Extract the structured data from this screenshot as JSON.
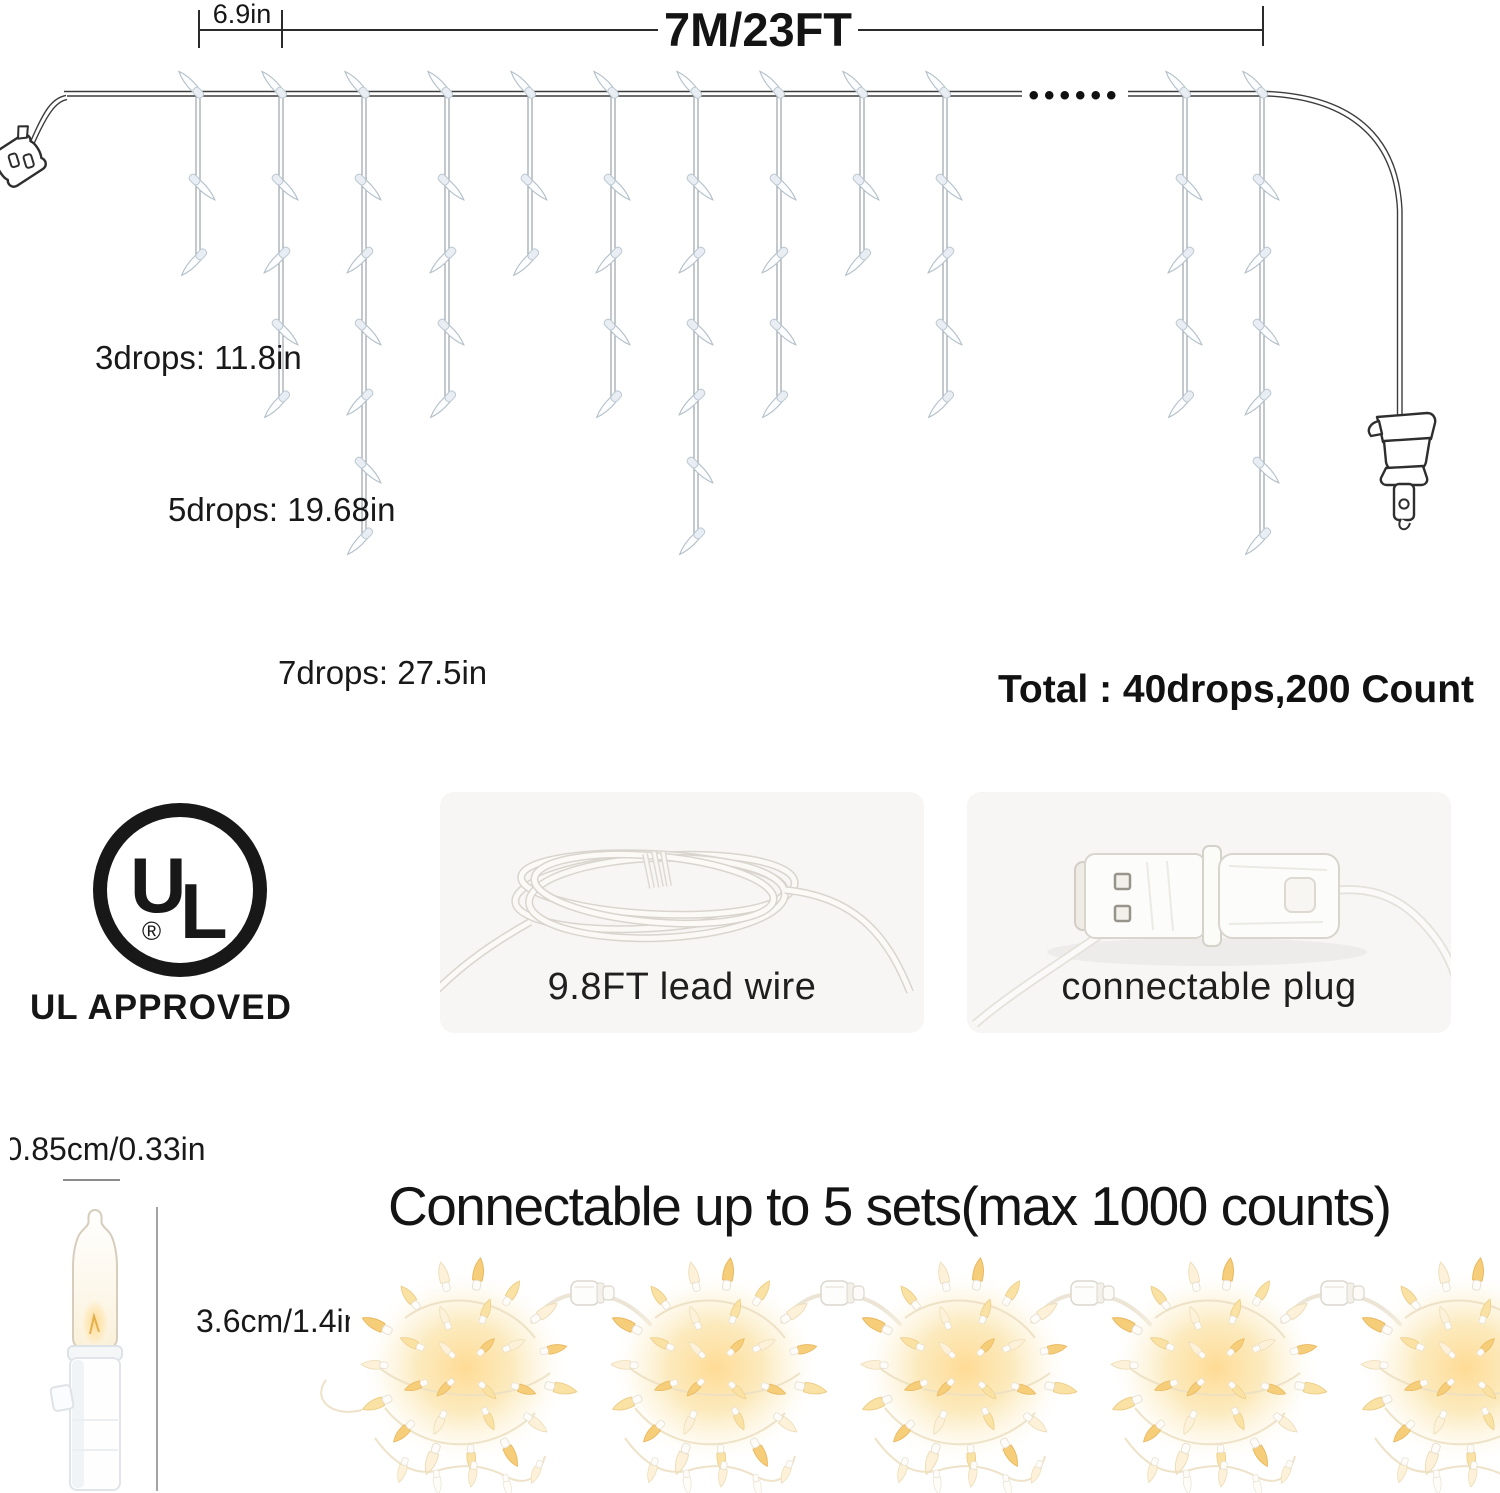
{
  "diagram": {
    "spacing_label": "6.9in",
    "length_label": "7M/23FT",
    "continuation_dots": "••••••",
    "label_3drops": "3drops: 11.8in",
    "label_5drops": "5drops: 19.68in",
    "label_7drops": "7drops: 27.5in",
    "total_label": "Total : 40drops,200 Count"
  },
  "certification": {
    "logo_u": "U",
    "logo_l": "L",
    "registered_mark": "®",
    "approved_label": "UL APPROVED"
  },
  "features": {
    "lead_wire_label": "9.8FT lead wire",
    "plug_label": "connectable plug"
  },
  "bulb": {
    "width_label": "0.85cm/0.33in",
    "height_label": "3.6cm/1.4in"
  },
  "connectivity": {
    "heading": "Connectable up to 5 sets(max 1000 counts)"
  }
}
